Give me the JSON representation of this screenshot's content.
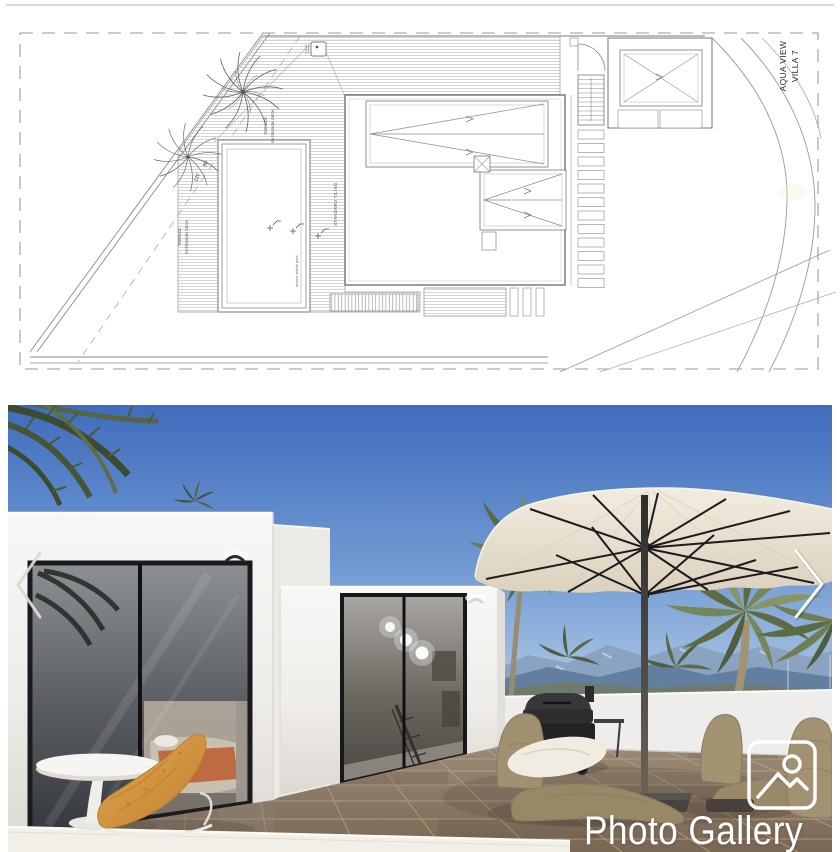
{
  "site_plan": {
    "type": "architectural-site-plan",
    "labels": {
      "project": {
        "line1": "AQUA VIEW",
        "line2": "VILLA 7"
      },
      "terrace_deck": {
        "line1": "TERRACE",
        "line2": "EXTENSION DECK"
      },
      "standard_tiling": "STANDARD TILING",
      "pool_note": "bench inside pool",
      "dims": {
        "a": "80",
        "b": "120"
      }
    }
  },
  "gallery": {
    "overlay_label": "Photo Gallery",
    "nav": {
      "prev": "chevron-left",
      "next": "chevron-right"
    },
    "icon": "image-placeholder",
    "colors": {
      "sky": "#4a74c4",
      "wall_white": "#f5f4f2",
      "tile_brown": "#8a7764",
      "umbrella_cream": "#ece5d6",
      "cushion_orange": "#d6983f",
      "mountain_blue": "#6d89ab",
      "overlay_text": "#ffffff"
    }
  }
}
